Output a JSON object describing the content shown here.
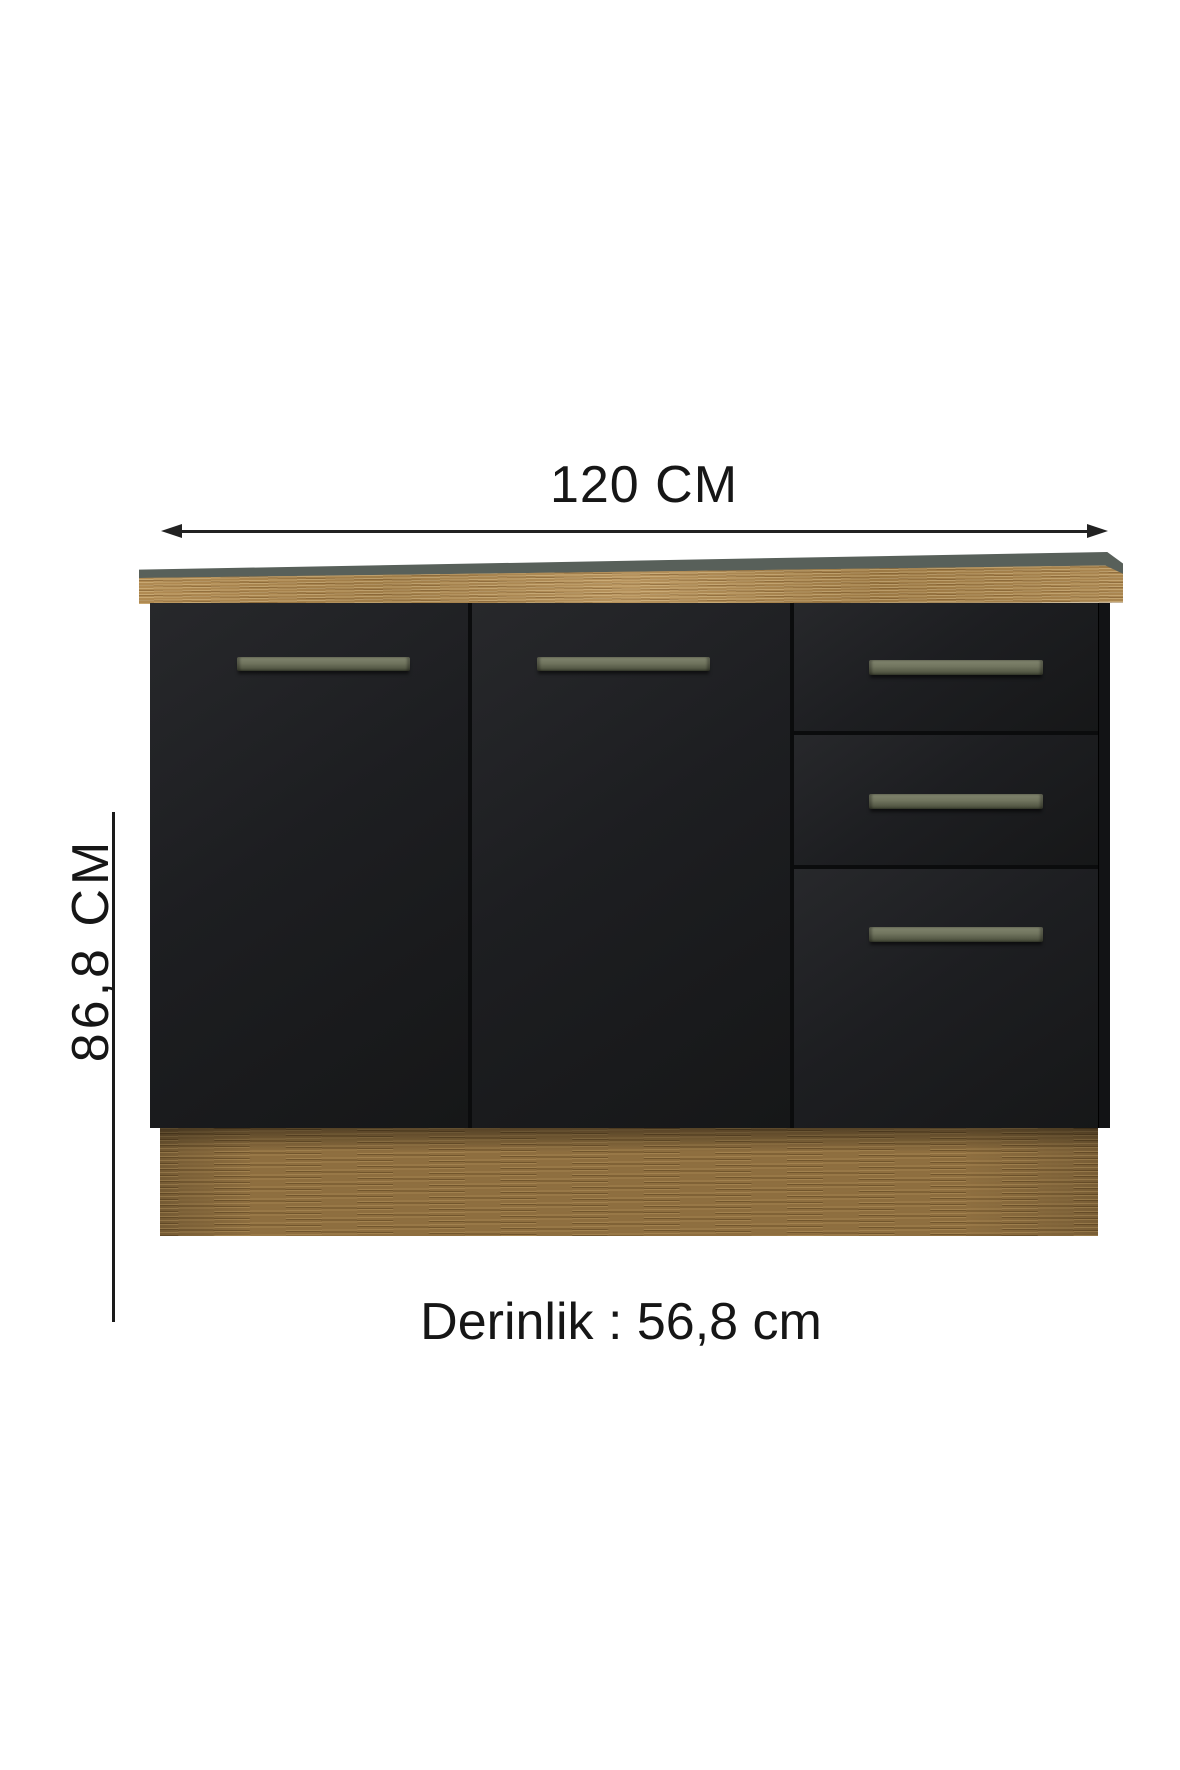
{
  "image_type": "furniture dimension diagram",
  "labels": {
    "width": "120 CM",
    "height": "86,8 CM",
    "depth": "Derinlik : 56,8 cm"
  },
  "dimensions": {
    "width_cm": "120",
    "height_cm": "86,8",
    "depth_cm": "56,8"
  },
  "cabinet": {
    "doors": 2,
    "drawers": 3,
    "handles": 5
  },
  "colors": {
    "background": "#ffffff",
    "body_black": "#1d1e21",
    "countertop_surface": "#58605a",
    "countertop_wood": "#aa8650",
    "plinth_wood": "#8e6e3f",
    "handle_olive": "#70745e",
    "dimension_line": "#1c1c1c"
  }
}
